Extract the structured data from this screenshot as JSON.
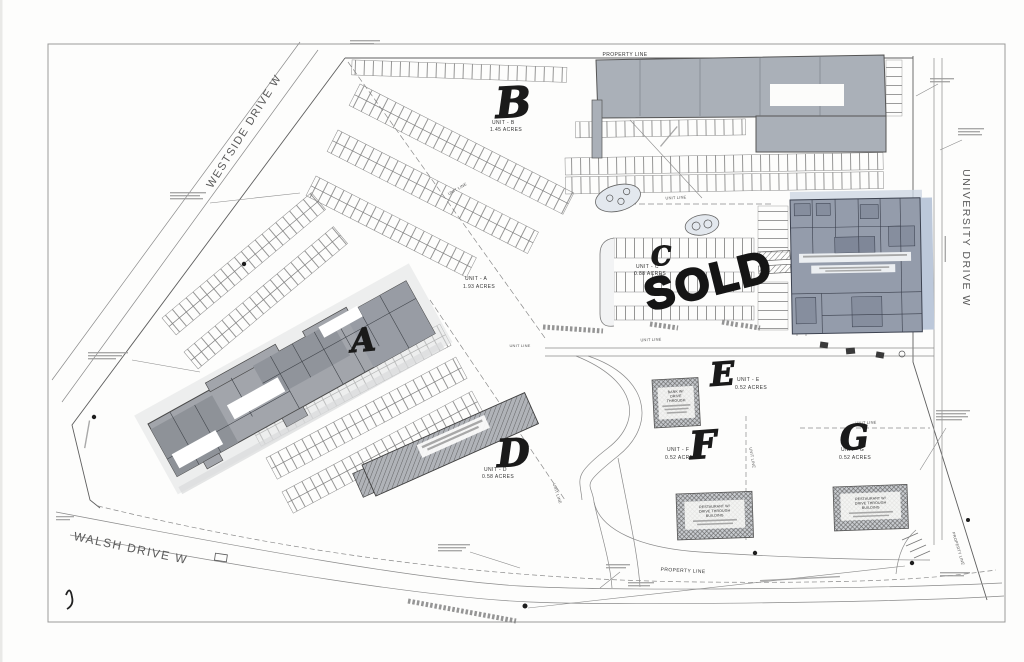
{
  "streets": {
    "westside": "WESTSIDE DRIVE W",
    "university": "UNIVERSITY DRIVE W",
    "walsh": "WALSH DRIVE W"
  },
  "labels": {
    "property_line": "PROPERTY LINE",
    "unit_line": "UNIT LINE"
  },
  "units": {
    "a": {
      "letter": "A",
      "name": "UNIT - A",
      "acres": "1.93 ACRES"
    },
    "b": {
      "letter": "B",
      "name": "UNIT - B",
      "acres": "1.45 ACRES"
    },
    "c": {
      "letter": "C",
      "name": "UNIT - C",
      "acres": "0.88 ACRES",
      "status": "SOLD"
    },
    "d": {
      "letter": "D",
      "name": "UNIT - D",
      "acres": "0.58 ACRES"
    },
    "e": {
      "letter": "E",
      "name": "UNIT - E",
      "acres": "0.52 ACRES"
    },
    "f": {
      "letter": "F",
      "name": "UNIT - F",
      "acres": "0.52 ACRES"
    },
    "g": {
      "letter": "G",
      "name": "UNIT - G",
      "acres": "0.52 ACRES"
    }
  },
  "buildings": {
    "bank": {
      "line1": "BANK W/",
      "line2": "DRIVE",
      "line3": "THROUGH"
    },
    "restaurant": {
      "line1": "RESTAURANT W/",
      "line2": "DRIVE THROUGH",
      "line3": "BUILDING"
    }
  },
  "colors": {
    "paper": "#fdfdfc",
    "plan_ink": "#5f5f5f",
    "building_gray": "#a9aeb6",
    "building_dark": "#949cab",
    "building_accent": "#bcc8da",
    "marker": "#1a1a1a"
  }
}
